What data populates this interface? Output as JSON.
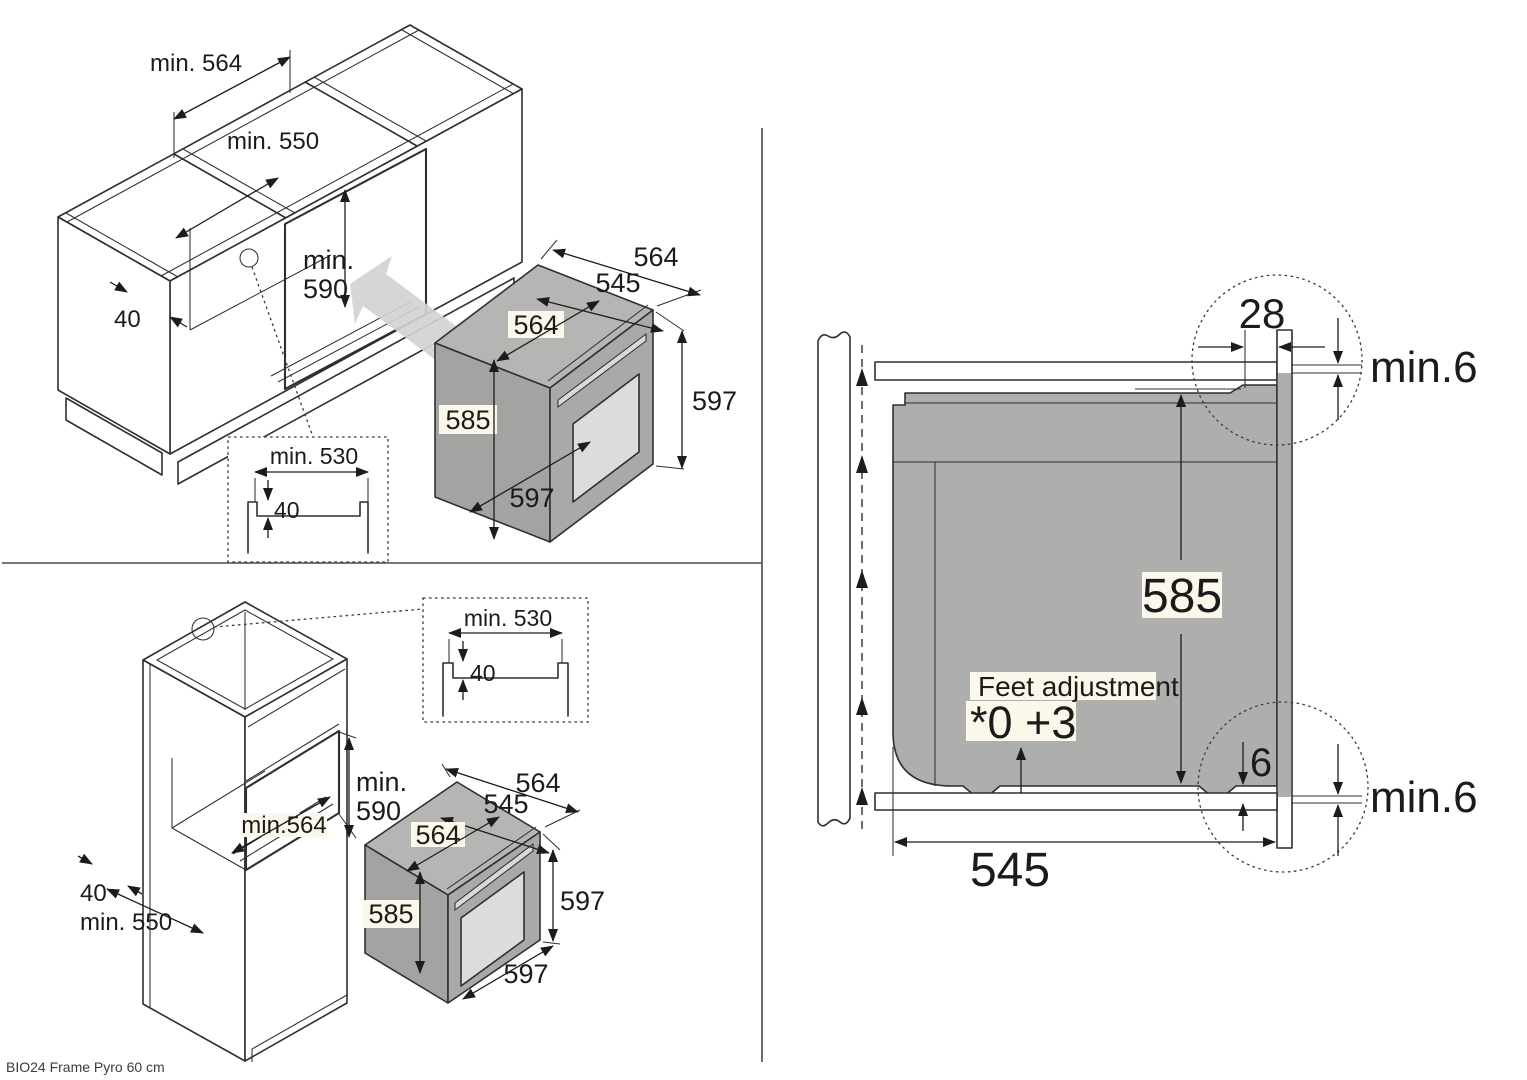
{
  "caption": "BIO24 Frame Pyro 60 cm",
  "colors": {
    "line": "#2f2f2f",
    "body_gray": "#aeaeac",
    "label_bg": "#fbf7ea"
  },
  "undercounter": {
    "opening_width": "min. 564",
    "opening_depth": "min. 550",
    "niche_height_l1": "min.",
    "niche_height_l2": "590",
    "front_rail": "40",
    "inset": {
      "recess_width": "min. 530",
      "recess_depth": "40"
    },
    "oven": {
      "total_depth": "564",
      "body_depth": "545",
      "body_width": "564",
      "body_height": "585",
      "front_height": "597",
      "front_width": "597"
    }
  },
  "tall_unit": {
    "niche_height_l1": "min.",
    "niche_height_l2": "590",
    "niche_width": "min.564",
    "front_rail": "40",
    "unit_depth": "min. 550",
    "inset": {
      "recess_width": "min. 530",
      "recess_depth": "40"
    },
    "oven": {
      "total_depth": "564",
      "body_depth": "545",
      "body_width": "564",
      "body_height": "585",
      "front_height": "597",
      "front_width": "597"
    }
  },
  "cross_section": {
    "frame_overhang": "28",
    "top_gap": "min.6",
    "body_height": "585",
    "feet_note": "Feet adjustment",
    "feet_values": "*0 +3",
    "bottom_front_gap": "6",
    "bottom_gap": "min.6",
    "body_depth": "545"
  }
}
